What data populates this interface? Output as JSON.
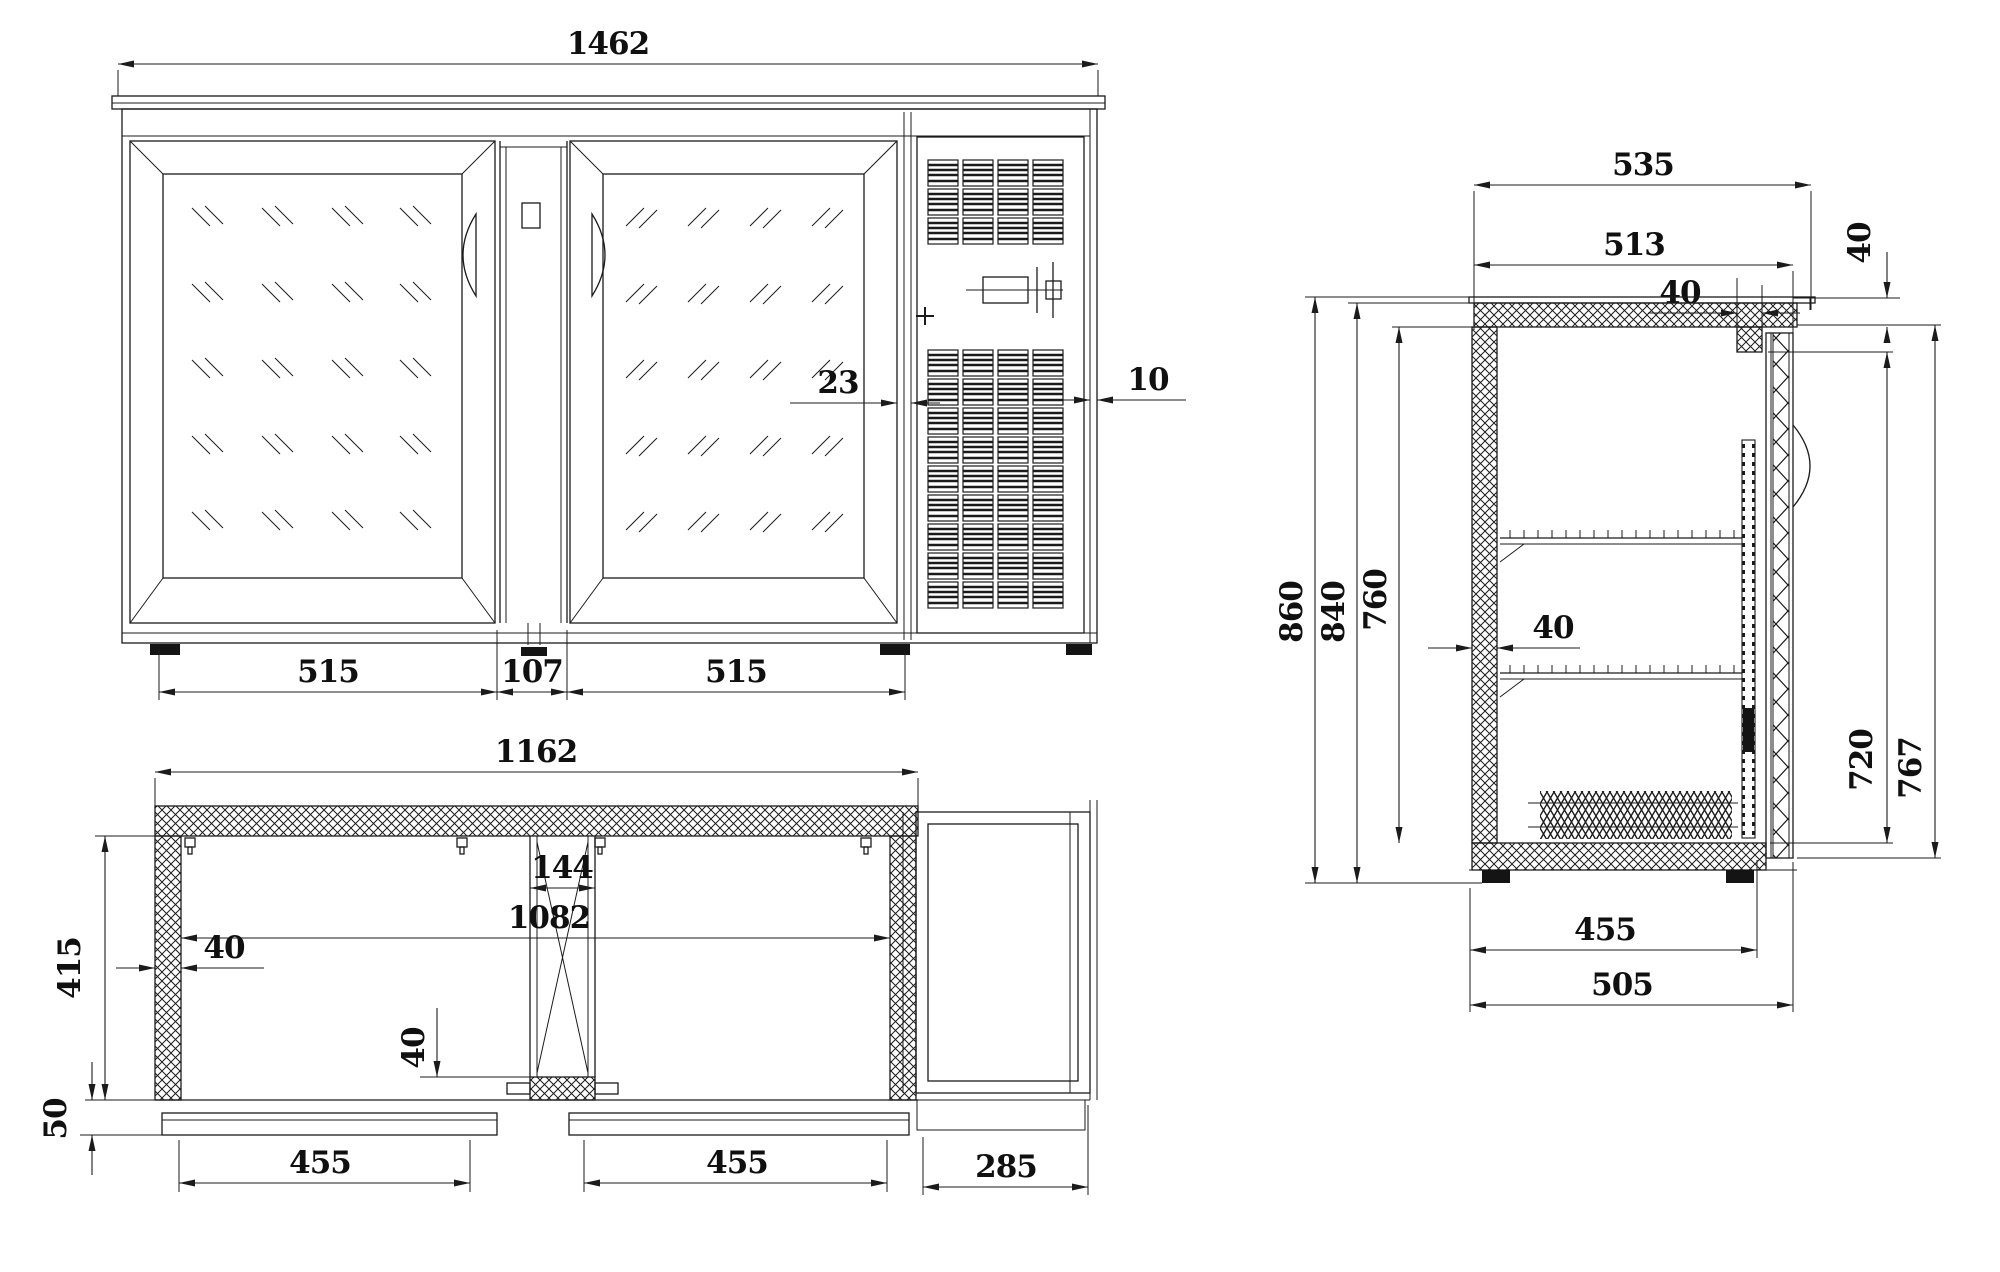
{
  "colors": {
    "background": "#ffffff",
    "line": "#1b1b1b"
  },
  "views": {
    "front": {
      "name": "front-elevation",
      "dims": {
        "overall_width": "1462",
        "door_gap": "23",
        "right_trim": "10",
        "left_door_width": "515",
        "center_post_width": "107",
        "right_door_width": "515"
      }
    },
    "plan": {
      "name": "top-plan-view",
      "dims": {
        "overall_width": "1162",
        "center_post": "144",
        "interior_width": "1082",
        "wall_thickness": "40",
        "interior_depth": "415",
        "door_thickness": "40",
        "door_offset": "50",
        "left_opening": "455",
        "right_opening": "455",
        "compressor_depth": "285"
      }
    },
    "side": {
      "name": "side-section-view",
      "dims": {
        "overall_depth": "535",
        "body_depth": "513",
        "recess_depth": "40",
        "top_thickness": "40",
        "overall_height": "860",
        "body_height": "840",
        "interior_height": "760",
        "wall_thickness": "40",
        "opening_height": "720",
        "door_height": "767",
        "interior_depth": "455",
        "base_depth": "505"
      }
    }
  }
}
